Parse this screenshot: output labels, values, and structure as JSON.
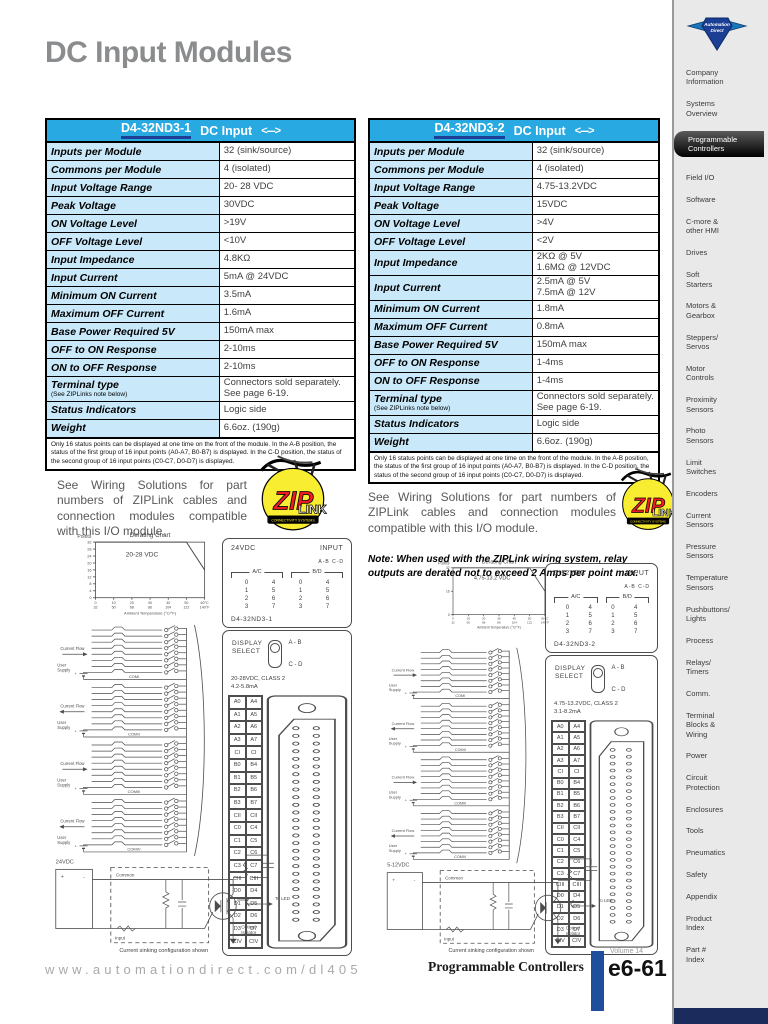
{
  "page": {
    "title": "DC Input Modules"
  },
  "colors": {
    "header_blue": "#29a9e1",
    "row_blue": "#c9e9fa",
    "underline_navy": "#1c3f94",
    "footer_bar_blue": "#1e4e9c",
    "bottom_navy": "#1b2b5b",
    "title_gray": "#8a8c8e"
  },
  "tables": [
    {
      "part": "D4-32ND3-1",
      "type": "DC Input",
      "arrow": "<--->",
      "rows": [
        {
          "label": "Inputs per Module",
          "value": "32 (sink/source)"
        },
        {
          "label": "Commons per Module",
          "value": "4 (isolated)"
        },
        {
          "label": "Input Voltage Range",
          "value": "20- 28 VDC"
        },
        {
          "label": "Peak Voltage",
          "value": "30VDC"
        },
        {
          "label": "ON Voltage Level",
          "value": ">19V"
        },
        {
          "label": "OFF Voltage Level",
          "value": "<10V"
        },
        {
          "label": "Input Impedance",
          "value": "4.8KΩ"
        },
        {
          "label": "Input Current",
          "value": "5mA @ 24VDC"
        },
        {
          "label": "Minimum ON Current",
          "value": "3.5mA"
        },
        {
          "label": "Maximum OFF Current",
          "value": "1.6mA"
        },
        {
          "label": "Base Power Required 5V",
          "value": "150mA max"
        },
        {
          "label": "OFF to ON Response",
          "value": "2-10ms"
        },
        {
          "label": "ON to OFF Response",
          "value": "2-10ms"
        },
        {
          "label": "Terminal type",
          "sub": "(See ZIPLinks note below)",
          "value": "Connectors sold separately.\nSee page 6-19."
        },
        {
          "label": "Status Indicators",
          "value": "Logic side"
        },
        {
          "label": "Weight",
          "value": "6.6oz. (190g)"
        }
      ],
      "footnote": "Only 16 status points can be displayed at one time on the front of the module. In the A-B position, the status of the first group of 16 input points (A0-A7, B0-B7) is displayed. In the C-D position, the status of the second group of 16 input points (C0-C7, D0-D7) is displayed."
    },
    {
      "part": "D4-32ND3-2",
      "type": "DC Input",
      "arrow": "<--->",
      "rows": [
        {
          "label": "Inputs per Module",
          "value": "32 (sink/source)"
        },
        {
          "label": "Commons per Module",
          "value": "4 (isolated)"
        },
        {
          "label": "Input Voltage Range",
          "value": "4.75-13.2VDC"
        },
        {
          "label": "Peak Voltage",
          "value": "15VDC"
        },
        {
          "label": "ON Voltage Level",
          "value": ">4V"
        },
        {
          "label": "OFF Voltage Level",
          "value": "<2V"
        },
        {
          "label": "Input Impedance",
          "value": "2KΩ @ 5V\n1.6MΩ @ 12VDC"
        },
        {
          "label": "Input Current",
          "value": "2.5mA @ 5V\n7.5mA @ 12V"
        },
        {
          "label": "Minimum ON Current",
          "value": "1.8mA"
        },
        {
          "label": "Maximum OFF Current",
          "value": "0.8mA"
        },
        {
          "label": "Base Power Required 5V",
          "value": "150mA max"
        },
        {
          "label": "OFF to ON Response",
          "value": "1-4ms"
        },
        {
          "label": "ON to OFF Response",
          "value": "1-4ms"
        },
        {
          "label": "Terminal type",
          "sub": "(See ZIPLinks note below)",
          "value": "Connectors sold separately.\nSee page 6-19."
        },
        {
          "label": "Status Indicators",
          "value": "Logic side"
        },
        {
          "label": "Weight",
          "value": "6.6oz. (190g)"
        }
      ],
      "footnote": "Only 16 status points can be displayed at one time on the front of the module. In the A-B position, the status of the first group of 16 input points (A0-A7, B0-B7) is displayed. In the C-D position, the status of the second group of 16 input points (C0-C7, D0-D7) is displayed."
    }
  ],
  "ziplink": {
    "left_text": "See Wiring Solutions for part numbers of ZIPLink cables and connection modules compatible with this I/O module.",
    "right_text": "See Wiring Solutions for part numbers of ZIPLink cables and connection modules compatible with this I/O module.",
    "note": "Note: When used with the ZIPLink wiring system, relay outputs are derated not to exceed 2 Amps per point max.",
    "logo": {
      "zip": "ZIP",
      "link": "LINK",
      "banner": "CONNECTIVITY SYSTEMS"
    }
  },
  "chart_data": [
    {
      "type": "line",
      "title": "Derating Chart",
      "ylabel": "Points",
      "xlabel": "Ambient Temperature (°C/°F)",
      "annotation": "20-28 VDC",
      "x": [
        0,
        50,
        60
      ],
      "y": [
        32,
        32,
        16
      ],
      "xlim": [
        0,
        60
      ],
      "ylim": [
        0,
        32
      ],
      "yticks": [
        32,
        28,
        24,
        20,
        16,
        12,
        8,
        4,
        0
      ],
      "xticks_c": [
        "0",
        "10",
        "20",
        "30",
        "40",
        "50",
        "60°C"
      ],
      "xticks_f": [
        "32",
        "50",
        "68",
        "86",
        "104",
        "122",
        "140°F"
      ],
      "grid": false,
      "legend": "none"
    },
    {
      "type": "line",
      "title": "Derating Chart",
      "ylabel": "Points",
      "xlabel": "Ambient Temperature (°C/°F)",
      "annotation": "4.75-13.2 VDC",
      "x": [
        0,
        50,
        60
      ],
      "y": [
        32,
        32,
        16
      ],
      "xlim": [
        0,
        60
      ],
      "ylim": [
        0,
        32
      ],
      "yticks": [
        32,
        16,
        0
      ],
      "xticks_c": [
        "0",
        "10",
        "20",
        "30",
        "40",
        "50",
        "60°C"
      ],
      "xticks_f": [
        "32",
        "50",
        "68",
        "86",
        "104",
        "122",
        "140°F"
      ],
      "grid": false,
      "legend": "none"
    }
  ],
  "diagrams": [
    {
      "module": {
        "voltage": "24VDC",
        "input_label": "INPUT",
        "ab_cd": "A-B  C-D",
        "group_left": "A/C",
        "group_right": "B/D",
        "numbers": [
          "0",
          "4",
          "0",
          "4",
          "1",
          "5",
          "1",
          "5",
          "2",
          "6",
          "2",
          "6",
          "3",
          "7",
          "3",
          "7"
        ],
        "part": "D4-32ND3-1",
        "display_select": "DISPLAY\nSELECT",
        "pos_ab": "A - B",
        "pos_cd": "C - D",
        "class_label": "20-28VDC, CLASS 2",
        "current_label": "4.2-5.8mA",
        "terminals": [
          [
            "A0",
            "A4"
          ],
          [
            "A1",
            "A5"
          ],
          [
            "A2",
            "A6"
          ],
          [
            "A3",
            "A7"
          ],
          [
            "CI",
            "CI"
          ],
          [
            "B0",
            "B4"
          ],
          [
            "B1",
            "B5"
          ],
          [
            "B2",
            "B6"
          ],
          [
            "B3",
            "B7"
          ],
          [
            "CII",
            "CII"
          ],
          [
            "C0",
            "C4"
          ],
          [
            "C1",
            "C5"
          ],
          [
            "C2",
            "C6"
          ],
          [
            "C3",
            "C7"
          ],
          [
            "CIII",
            "CIII"
          ],
          [
            "D0",
            "D4"
          ],
          [
            "D1",
            "D5"
          ],
          [
            "D2",
            "D6"
          ],
          [
            "D3",
            "D7"
          ],
          [
            "CIV",
            "CIV"
          ]
        ]
      },
      "schematic": {
        "current_flow": "Current Flow",
        "user_supply": "User\nSupply",
        "coms": [
          "COMI",
          "COMII",
          "COMIII",
          "COMIV"
        ]
      },
      "circuit": {
        "supply": "24VDC",
        "common": "Common",
        "input": "Input",
        "to_led": "To LED",
        "opto": "Optical\nIsolator",
        "caption": "Current sinking configuration shown"
      }
    },
    {
      "module": {
        "voltage": "5-12VDC",
        "input_label": "INPUT",
        "ab_cd": "A-B  C-D",
        "group_left": "A/C",
        "group_right": "B/D",
        "numbers": [
          "0",
          "4",
          "0",
          "4",
          "1",
          "5",
          "1",
          "5",
          "2",
          "6",
          "2",
          "6",
          "3",
          "7",
          "3",
          "7"
        ],
        "part": "D4-32ND3-2",
        "display_select": "DISPLAY\nSELECT",
        "pos_ab": "A - B",
        "pos_cd": "C - D",
        "class_label": "4.75-13.2VDC, CLASS 2",
        "current_label": "3.1-8.2mA",
        "terminals": [
          [
            "A0",
            "A4"
          ],
          [
            "A1",
            "A5"
          ],
          [
            "A2",
            "A6"
          ],
          [
            "A3",
            "A7"
          ],
          [
            "CI",
            "CI"
          ],
          [
            "B0",
            "B4"
          ],
          [
            "B1",
            "B5"
          ],
          [
            "B2",
            "B6"
          ],
          [
            "B3",
            "B7"
          ],
          [
            "CII",
            "CII"
          ],
          [
            "C0",
            "C4"
          ],
          [
            "C1",
            "C5"
          ],
          [
            "C2",
            "C6"
          ],
          [
            "C3",
            "C7"
          ],
          [
            "CIII",
            "CIII"
          ],
          [
            "D0",
            "D4"
          ],
          [
            "D1",
            "D5"
          ],
          [
            "D2",
            "D6"
          ],
          [
            "D3",
            "D7"
          ],
          [
            "CIV",
            "CIV"
          ]
        ]
      },
      "schematic": {
        "current_flow": "Current Flow",
        "user_supply": "User\nSupply",
        "coms": [
          "COMI",
          "COMII",
          "COMIII",
          "COMIV"
        ]
      },
      "circuit": {
        "supply": "5-12VDC",
        "common": "Common",
        "input": "Input",
        "to_led": "To LED",
        "opto": "Optical\nIsolator",
        "caption": "Current sinking configuration shown"
      }
    }
  ],
  "sidebar": {
    "logo": "AutomationDirect",
    "selected_index": 2,
    "items": [
      "Company\nInformation",
      "Systems\nOverview",
      "Programmable\nControllers",
      "Field I/O",
      "Software",
      "C-more &\nother HMI",
      "Drives",
      "Soft\nStarters",
      "Motors &\nGearbox",
      "Steppers/\nServos",
      "Motor\nControls",
      "Proximity\nSensors",
      "Photo\nSensors",
      "Limit\nSwitches",
      "Encoders",
      "Current\nSensors",
      "Pressure\nSensors",
      "Temperature\nSensors",
      "Pushbuttons/\nLights",
      "Process",
      "Relays/\nTimers",
      "Comm.",
      "Terminal\nBlocks &\nWiring",
      "Power",
      "Circuit\nProtection",
      "Enclosures",
      "Tools",
      "Pneumatics",
      "Safety",
      "Appendix",
      "Product\nIndex",
      "Part #\nIndex"
    ]
  },
  "footer": {
    "url": "www.automationdirect.com/dl405",
    "section": "Programmable Controllers",
    "volume": "Volume 14",
    "page": "e6-61"
  }
}
